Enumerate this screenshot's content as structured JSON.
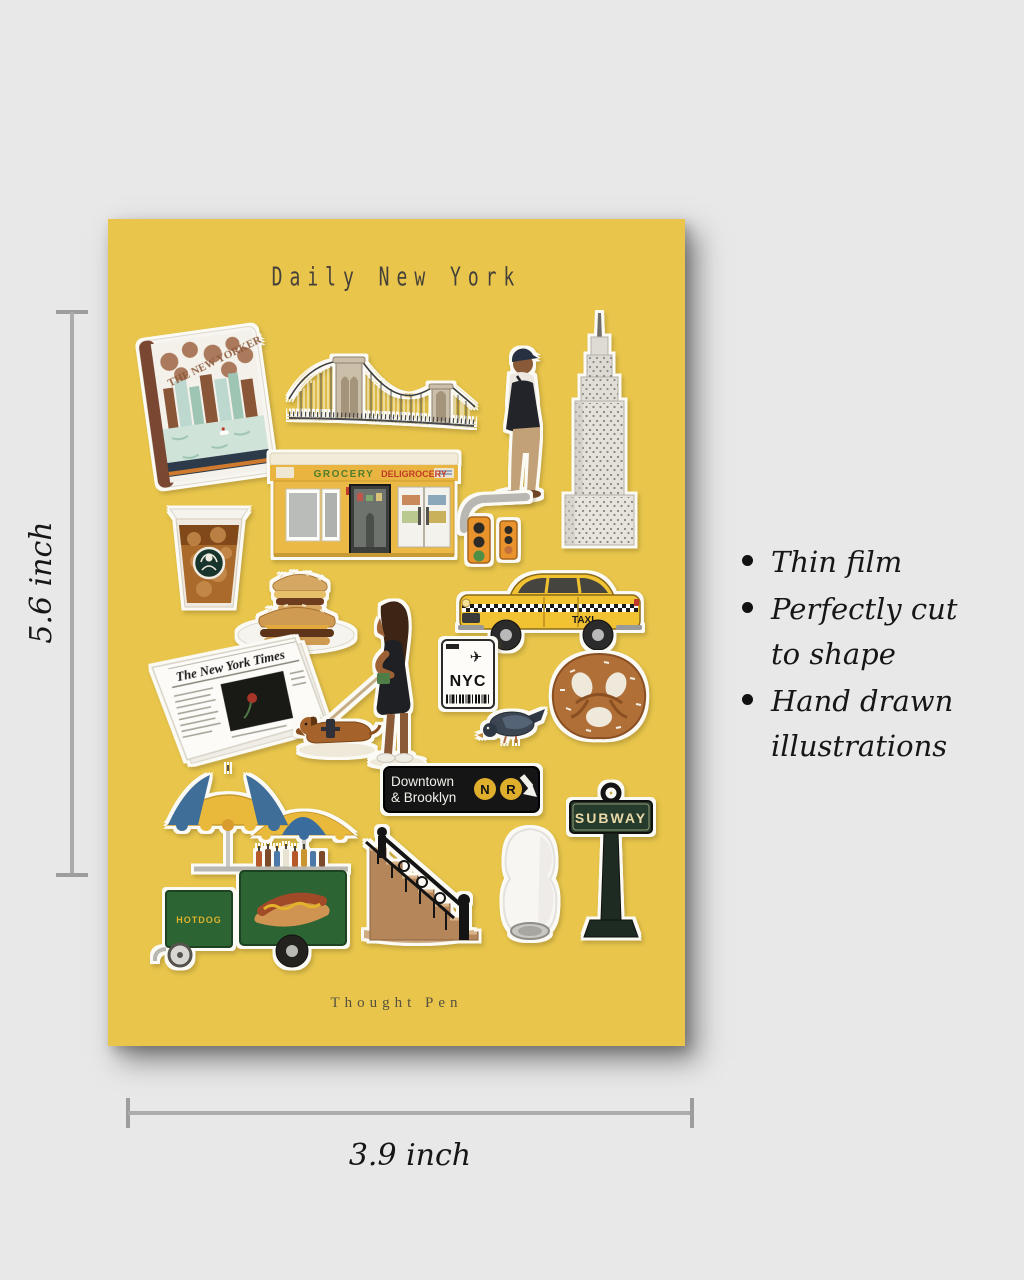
{
  "colors": {
    "page_background": "#e8e8e8",
    "poster_background": "#e9c64b",
    "dimension_line": "#acacac",
    "text": "#161616",
    "taxi_yellow": "#f1c232",
    "subway_sign_green": "#253c2d",
    "cart_green": "#2c6434"
  },
  "poster": {
    "title": "Daily New York",
    "brand": "Thought Pen"
  },
  "measurements": {
    "height": "5.6 inch",
    "width": "3.9 inch"
  },
  "features": [
    "Thin film",
    "Perfectly cut to shape",
    "Hand drawn illustrations"
  ],
  "stickers": {
    "magazine": {
      "masthead": "THE NEW YORKER"
    },
    "newspaper": {
      "masthead": "The New York Times"
    },
    "deli": {
      "sign_grocery": "GROCERY",
      "sign_deligrocery": "DELIGROCERY"
    },
    "taxi": {
      "door_label": "TAXI"
    },
    "luggage_tag": {
      "city_code": "NYC"
    },
    "subway_bullet_sign": {
      "line1": "Downtown",
      "line2": "& Brooklyn",
      "route_n": "N",
      "route_r": "R"
    },
    "subway_post": {
      "label": "SUBWAY"
    },
    "hotdog_cart": {
      "label": "HOTDOG"
    }
  }
}
